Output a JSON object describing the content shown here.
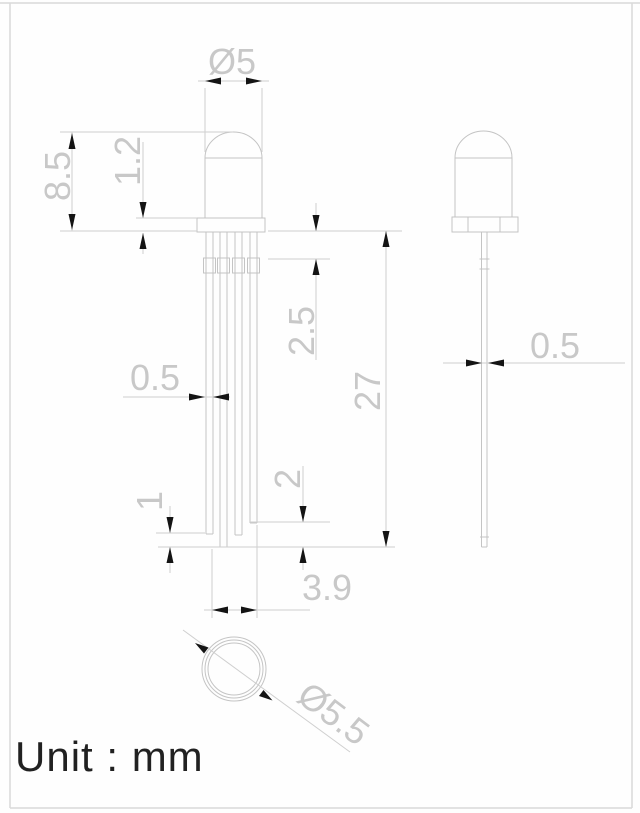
{
  "page": {
    "background_color": "#fefefe",
    "line_color": "#c4c4c4",
    "dim_text_color": "#c8c8c8",
    "arrow_color": "#141414",
    "unit_text_color": "#212121"
  },
  "title": {
    "unit_label": "Unit : mm"
  },
  "views": {
    "front": {
      "dimensions": {
        "lens_diameter": "Ø5",
        "body_height": "8.5",
        "flange_thickness": "1.2",
        "lead_crimp_offset": "2.5",
        "lead_length": "27",
        "lead_width": "0.5",
        "lead_step_short": "1",
        "lead_step_shorter": "2",
        "lead_span": "3.9"
      }
    },
    "side": {
      "dimensions": {
        "lead_thickness": "0.5"
      }
    },
    "bottom": {
      "dimensions": {
        "flange_diameter": "Ø5.5"
      }
    }
  }
}
